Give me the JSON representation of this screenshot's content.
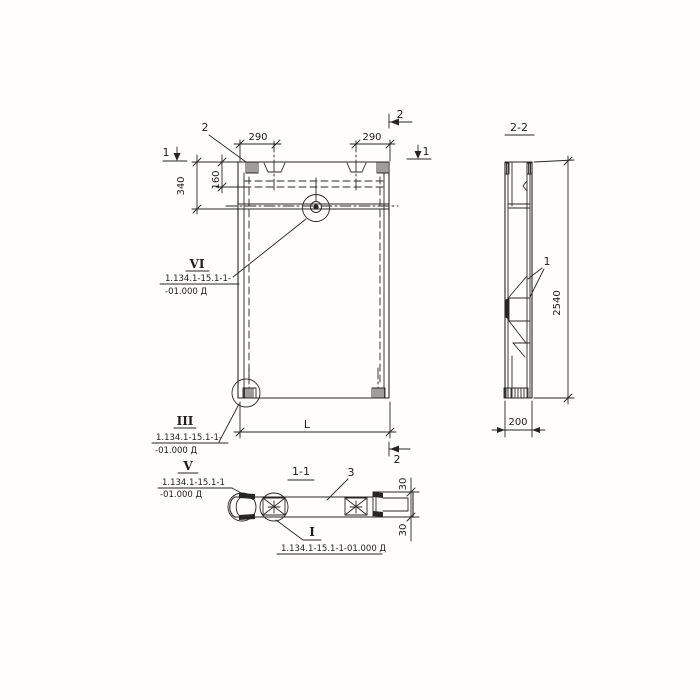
{
  "colors": {
    "ink": "#262626",
    "paper": "#ffffff"
  },
  "front": {
    "dim290L": "290",
    "dim290R": "290",
    "dim340": "340",
    "dim160": "160",
    "dimL": "L",
    "marker1": "1",
    "marker2": "2",
    "cornerLabel": "2"
  },
  "side": {
    "title": "2-2",
    "height": "2540",
    "width": "200",
    "part1": "1"
  },
  "section": {
    "title": "1-1",
    "part3": "3",
    "dim30": "30"
  },
  "callouts": {
    "vi": {
      "numeral": "VI",
      "line1": "1.134.1-15.1-1-",
      "line2": "-01.000 Д"
    },
    "iii": {
      "numeral": "III",
      "line1": "1.134.1-15.1-1-",
      "line2": "-01.000 Д"
    },
    "v": {
      "numeral": "V",
      "line1": "1.134.1-15.1-1",
      "line2": "-01.000 Д"
    },
    "i": {
      "numeral": "I",
      "line": "1.134.1-15.1-1-01.000 Д"
    }
  }
}
